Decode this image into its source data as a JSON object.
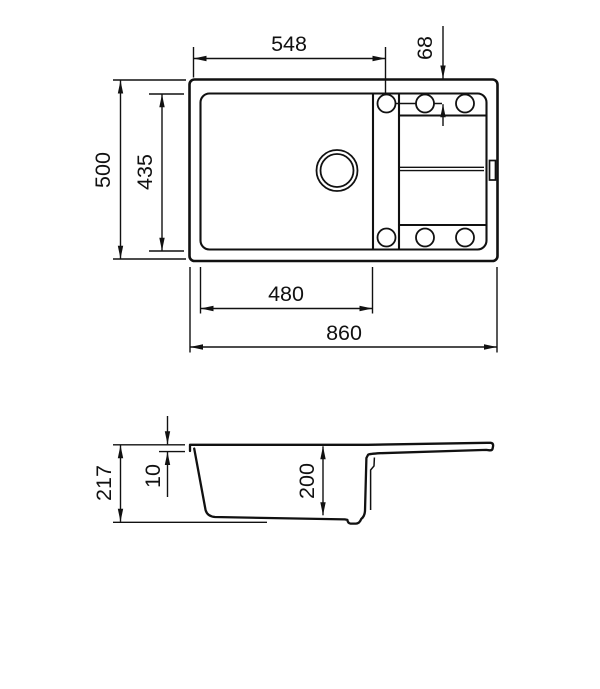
{
  "colors": {
    "line": "#111111",
    "background": "#ffffff"
  },
  "top_view": {
    "dim_top_width": "548",
    "dim_hole_offset": "68",
    "dim_overall_depth": "500",
    "dim_bowl_inner_depth": "435",
    "dim_bowl_width": "480",
    "dim_overall_width": "860"
  },
  "side_view": {
    "dim_overall_height": "217",
    "dim_rim_thickness": "10",
    "dim_bowl_depth": "200"
  }
}
